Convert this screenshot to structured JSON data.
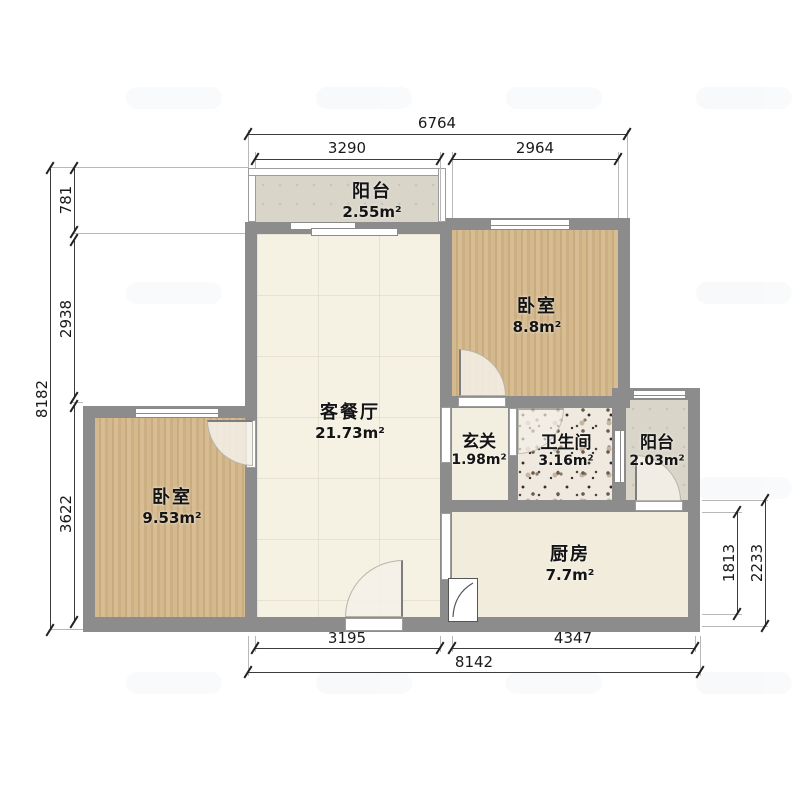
{
  "plan": {
    "rooms": {
      "balcony_top": {
        "name": "阳台",
        "area": "2.55m²"
      },
      "bedroom_right": {
        "name": "卧室",
        "area": "8.8m²"
      },
      "living_dining": {
        "name": "客餐厅",
        "area": "21.73m²"
      },
      "entry_hall": {
        "name": "玄关",
        "area": "1.98m²"
      },
      "bathroom": {
        "name": "卫生间",
        "area": "3.16m²"
      },
      "balcony_right": {
        "name": "阳台",
        "area": "2.03m²"
      },
      "bedroom_left": {
        "name": "卧室",
        "area": "9.53m²"
      },
      "kitchen": {
        "name": "厨房",
        "area": "7.7m²"
      }
    },
    "dimensions_mm": {
      "top": {
        "total": "6764",
        "segment_left": "3290",
        "segment_right": "2964"
      },
      "left": {
        "total": "8182",
        "segment_top": "781",
        "segment_middle": "2938",
        "segment_bottom": "3622"
      },
      "right": {
        "segment_inner": "1813",
        "segment_outer": "2233"
      },
      "bottom": {
        "segment_left": "3195",
        "segment_right": "4347",
        "total": "8142"
      }
    },
    "colors": {
      "wall": "#8c8c8c",
      "wood_floor": "#d0b489",
      "tile_floor": "#f5f1e3",
      "balcony_floor": "#d9d5c9",
      "terrazzo_base": "#efe9df"
    },
    "decor": {
      "watermark_glyph": "✓"
    }
  }
}
